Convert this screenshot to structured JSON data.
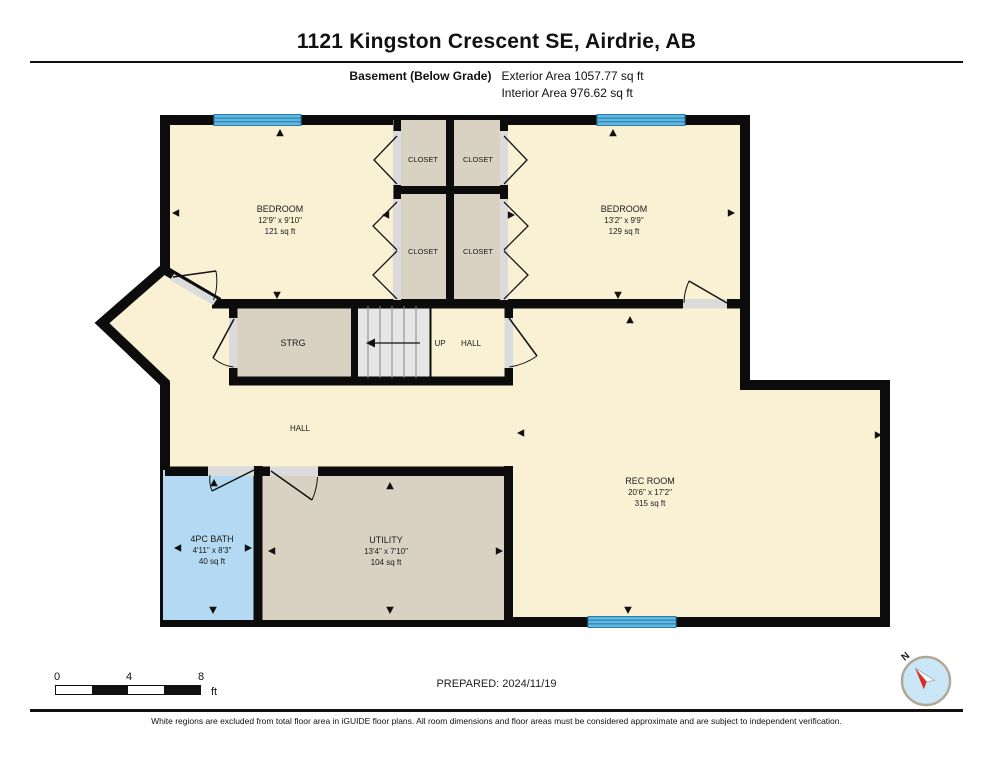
{
  "header": {
    "title": "1121 Kingston Crescent SE, Airdrie, AB",
    "floor_label": "Basement (Below Grade)",
    "exterior_area": "Exterior Area 1057.77 sq ft",
    "interior_area": "Interior Area 976.62 sq ft"
  },
  "rooms": {
    "bedroom_left": {
      "name": "BEDROOM",
      "dims": "12'9\" x 9'10\"",
      "area": "121 sq ft"
    },
    "bedroom_right": {
      "name": "BEDROOM",
      "dims": "13'2\" x 9'9\"",
      "area": "129 sq ft"
    },
    "closet_tl": {
      "name": "CLOSET"
    },
    "closet_tr": {
      "name": "CLOSET"
    },
    "closet_bl": {
      "name": "CLOSET"
    },
    "closet_br": {
      "name": "CLOSET"
    },
    "strg": {
      "name": "STRG"
    },
    "stairs": {
      "up_label": "UP"
    },
    "hall_landing": {
      "name": "HALL"
    },
    "hall": {
      "name": "HALL"
    },
    "bath": {
      "name": "4PC BATH",
      "dims": "4'11\" x 8'3\"",
      "area": "40 sq ft"
    },
    "utility": {
      "name": "UTILITY",
      "dims": "13'4\" x 7'10\"",
      "area": "104 sq ft"
    },
    "rec_room": {
      "name": "REC ROOM",
      "dims": "20'6\" x 17'2\"",
      "area": "315 sq ft"
    }
  },
  "scale_bar": {
    "tick_0": "0",
    "tick_4": "4",
    "tick_8": "8",
    "unit": "ft"
  },
  "prepared_label": "PREPARED: 2024/11/19",
  "compass": {
    "north_label": "N"
  },
  "footer_text": "White regions are excluded from total floor area in iGUIDE floor plans. All room dimensions and floor areas must be considered approximate and are subject to independent verification.",
  "colors": {
    "room_fill": "#FAF0D3",
    "closet_fill": "#D9D2C3",
    "bath_fill": "#B3DAF2",
    "stairs_fill": "#E6E6E6",
    "window_fill": "#5FB9E3",
    "window_line": "#2E7CA8",
    "wall": "#0C0C0C",
    "door_opening": "#DBDBDB",
    "compass_red": "#D92B21",
    "compass_circle": "#CBE7F7"
  }
}
